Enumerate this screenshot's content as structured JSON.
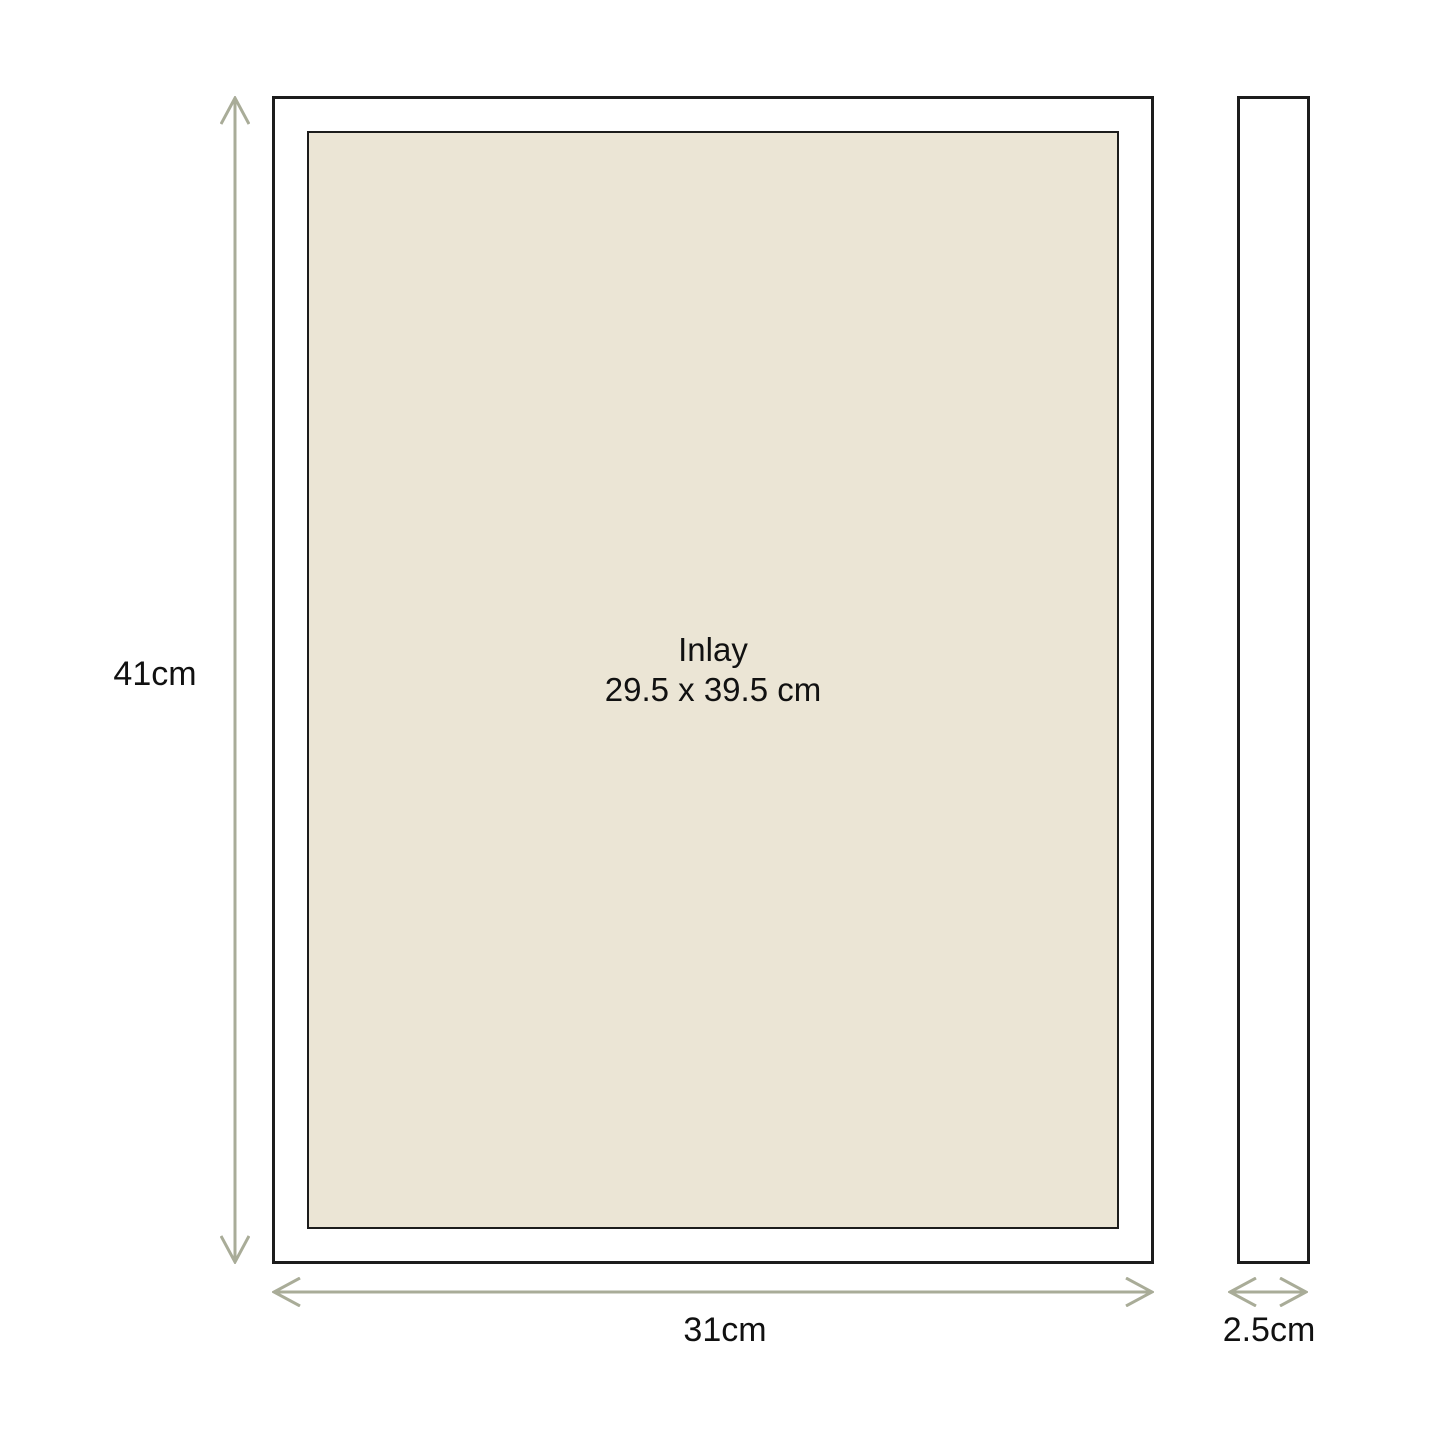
{
  "front_view": {
    "height_label": "41cm",
    "width_label": "31cm",
    "inlay": {
      "name": "Inlay",
      "size": "29.5 x 39.5 cm"
    }
  },
  "side_view": {
    "depth_label": "2.5cm"
  },
  "colors": {
    "bg": "#ffffff",
    "line": "#1c1c1c",
    "inlay-bg": "#ebe5d5",
    "arrow": "#a9ac98",
    "text": "#111111"
  }
}
